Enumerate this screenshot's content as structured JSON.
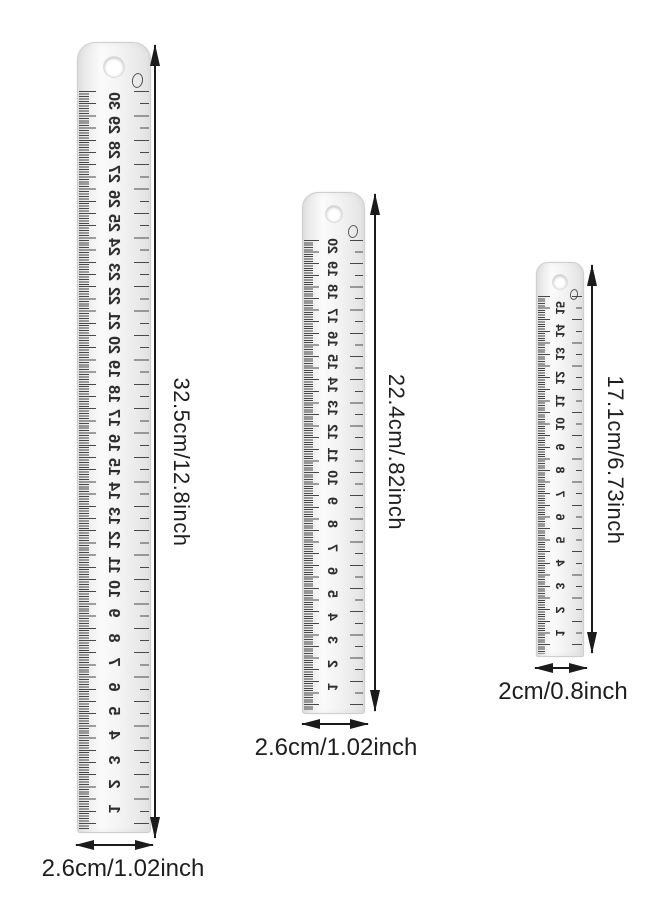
{
  "colors": {
    "ink": "#1e1e1e",
    "tick": "#474747",
    "number": "#2e2e2e",
    "dim": "#1b1b1b",
    "metal_light": "#fbfbfb",
    "metal_mid": "#f2f2f2",
    "metal_dark": "#e3e3e3",
    "metal_border": "#cfcfcf"
  },
  "rulers": [
    {
      "length_label": "32.5cm/12.8inch",
      "width_label": "2.6cm/1.02inch",
      "numbers": [
        30,
        29,
        28,
        27,
        26,
        25,
        24,
        23,
        22,
        21,
        20,
        19,
        18,
        17,
        16,
        15,
        14,
        13,
        12,
        11,
        10,
        9,
        8,
        7,
        6,
        5,
        4,
        3,
        2,
        1
      ]
    },
    {
      "length_label": "22.4cm/.82inch",
      "width_label": "2.6cm/1.02inch",
      "numbers": [
        20,
        19,
        18,
        17,
        16,
        15,
        14,
        13,
        12,
        11,
        10,
        9,
        8,
        7,
        6,
        5,
        4,
        3,
        2,
        1
      ]
    },
    {
      "length_label": "17.1cm/6.73inch",
      "width_label": "2cm/0.8inch",
      "numbers": [
        15,
        14,
        13,
        12,
        11,
        10,
        9,
        8,
        7,
        6,
        5,
        4,
        3,
        2,
        1
      ]
    }
  ]
}
